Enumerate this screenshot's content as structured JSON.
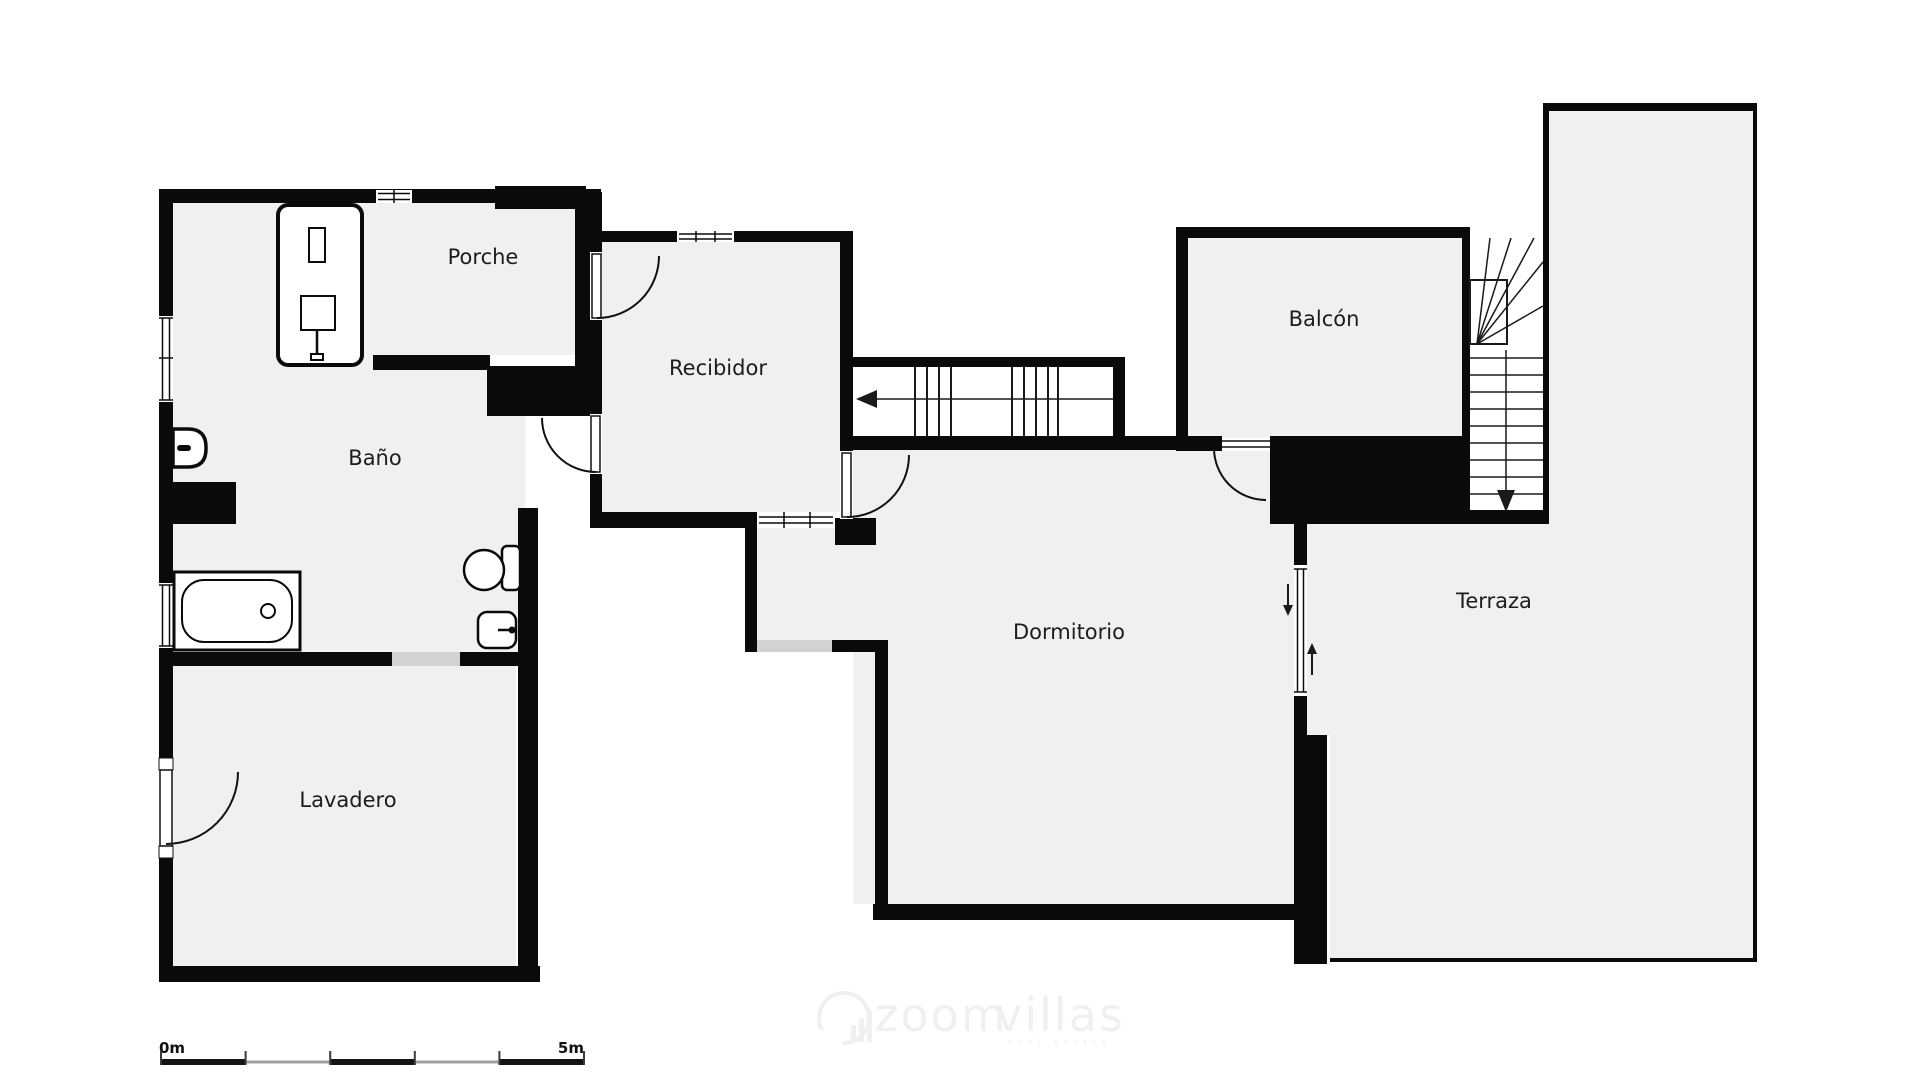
{
  "title": "Floor plan - planta con Porche, Recibidor, Baño, Balcón, Dormitorio, Lavadero y Terraza",
  "rooms": [
    {
      "id": "bano",
      "label": "Baño"
    },
    {
      "id": "porche",
      "label": "Porche"
    },
    {
      "id": "recibidor",
      "label": "Recibidor"
    },
    {
      "id": "balcon",
      "label": "Balcón"
    },
    {
      "id": "dormitorio",
      "label": "Dormitorio"
    },
    {
      "id": "lavadero",
      "label": "Lavadero"
    },
    {
      "id": "terraza",
      "label": "Terraza"
    }
  ],
  "scale_bar": {
    "start_label": "0m",
    "end_label": "5m",
    "segments": 5,
    "meters_total": 5
  },
  "watermark": {
    "brand_left": "zoom",
    "brand_right": "villas",
    "tagline": "real estate",
    "logo": "bar-chart-circle-icon"
  },
  "icons": [
    "shower-icon",
    "bathtub-icon",
    "toilet-icon",
    "bidet-icon",
    "sink-icon",
    "door-swing-icon",
    "window-icon",
    "stairs-icon",
    "arrow-left-icon",
    "arrow-down-icon",
    "arrow-up-icon"
  ],
  "colors": {
    "wall": "#0a0a0a",
    "room_fill": "#f0f0f1",
    "sill": "#d2d2d2",
    "stair_line": "#1a1a1a",
    "scale_black": "#141414",
    "scale_gray": "#a0a0a0",
    "watermark": "#f0f0f0",
    "background": "#ffffff"
  }
}
